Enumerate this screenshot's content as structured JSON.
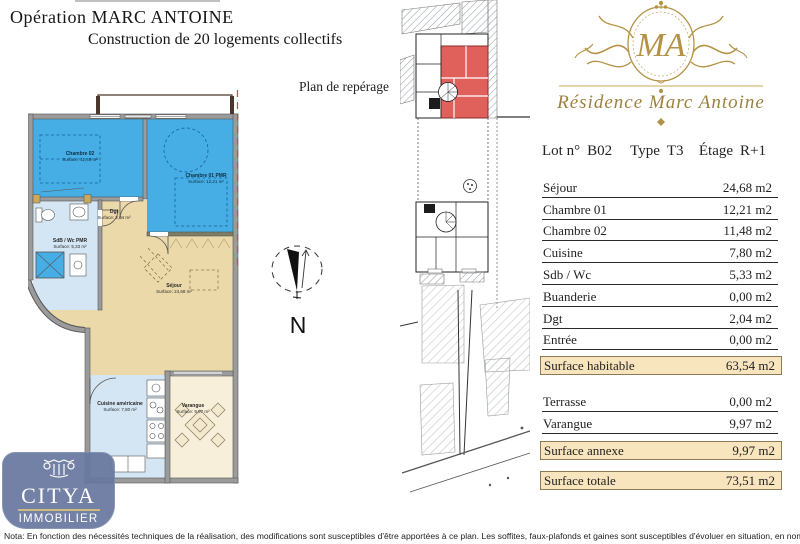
{
  "header": {
    "title": "Opération MARC ANTOINE",
    "subtitle": "Construction de 20 logements collectifs",
    "plan_label": "Plan de repérage"
  },
  "compass": {
    "north_label": "N"
  },
  "floor_plan": {
    "rooms": [
      {
        "name": "Chambre 02",
        "area": "Surface: 11,48 m²"
      },
      {
        "name": "Chambre 01 PMR",
        "area": "Surface: 12,21 m²"
      },
      {
        "name": "SdB / Wc PMR",
        "area": "Surface: 5,33 m²"
      },
      {
        "name": "Dgt",
        "area": "Surface: 2,04 m²"
      },
      {
        "name": "Séjour",
        "area": "Surface: 24,68 m²"
      },
      {
        "name": "Cuisine américaine",
        "area": "Surface: 7,80 m²"
      },
      {
        "name": "Varangue",
        "area": "Surface: 9,97 m²"
      }
    ],
    "colors": {
      "bedroom_blue": "#46aee4",
      "wet_blue": "#d4e6f3",
      "living_beige": "#ecd9a9",
      "varangue_cream": "#f7efd9",
      "wall_grey": "#9b9b9b",
      "marker_red": "#c0504d"
    }
  },
  "site_plan": {
    "highlighted_unit_color": "#e0605c"
  },
  "brand": {
    "monogram": "MA",
    "residence_title": "Résidence Marc Antoine",
    "gold": "#b09045"
  },
  "lot": {
    "lot_label": "Lot n°",
    "lot_value": "B02",
    "type_label": "Type",
    "type_value": "T3",
    "floor_label": "Étage",
    "floor_value": "R+1"
  },
  "areas": {
    "rows": [
      {
        "label": "Séjour",
        "value": "24,68 m2"
      },
      {
        "label": "Chambre 01",
        "value": "12,21 m2"
      },
      {
        "label": "Chambre 02",
        "value": "11,48 m2"
      },
      {
        "label": "Cuisine",
        "value": "7,80 m2"
      },
      {
        "label": "Sdb / Wc",
        "value": "5,33 m2"
      },
      {
        "label": "Buanderie",
        "value": "0,00 m2"
      },
      {
        "label": "Dgt",
        "value": "2,04 m2"
      },
      {
        "label": "Entrée",
        "value": "0,00 m2"
      }
    ],
    "surface_habitable": {
      "label": "Surface habitable",
      "value": "63,54 m2"
    },
    "annex_rows": [
      {
        "label": "Terrasse",
        "value": "0,00 m2"
      },
      {
        "label": "Varangue",
        "value": "9,97 m2"
      }
    ],
    "surface_annexe": {
      "label": "Surface annexe",
      "value": "9,97 m2"
    },
    "surface_totale": {
      "label": "Surface totale",
      "value": "73,51 m2"
    },
    "highlight_bg": "#f8e5bd"
  },
  "citya": {
    "name": "CITYA",
    "sub": "IMMOBILIER"
  },
  "footer": {
    "nota": "Nota: En fonction des nécessités techniques de la réalisation, des modifications sont susceptibles d'être apportées à ce plan. Les soffites, faux-plafonds et gaines sont susceptibles d'évoluer en situation, en nombre et dimensions. Les"
  }
}
